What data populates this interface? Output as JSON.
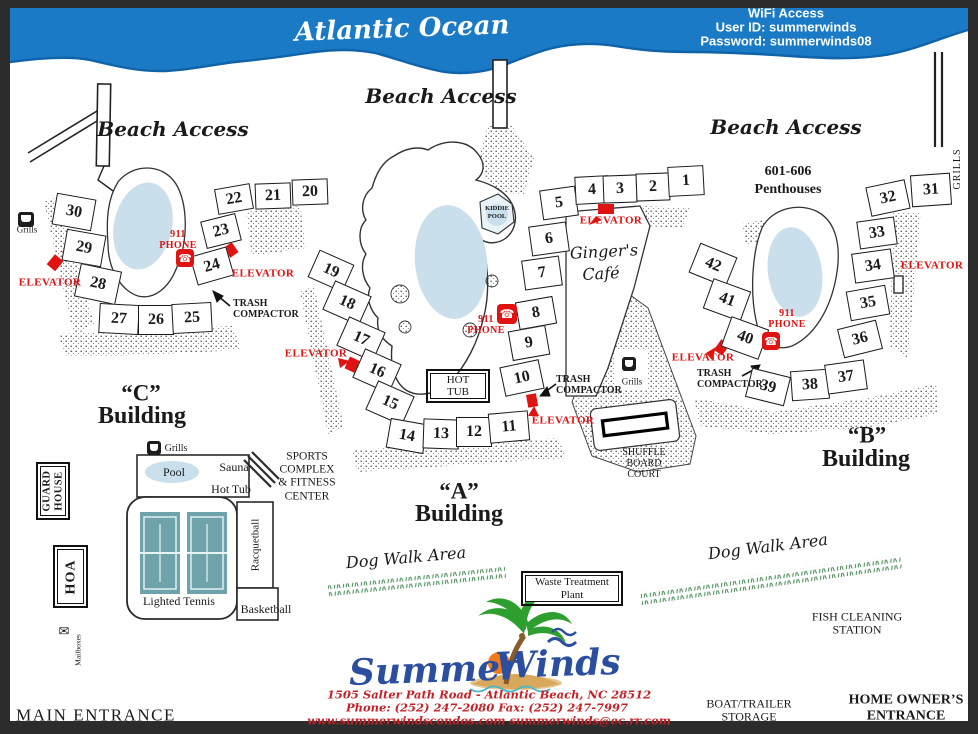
{
  "ocean": {
    "label": "Atlantic Ocean"
  },
  "wifi": {
    "title": "WiFi Access",
    "user": "User ID: summerwinds",
    "password": "Password: summerwinds08"
  },
  "beach_access": {
    "left": "Beach Access",
    "center": "Beach Access",
    "right": "Beach Access"
  },
  "penthouses": {
    "range": "601-606",
    "label": "Penthouses"
  },
  "buildings": {
    "c": {
      "quote": "“C”",
      "label": "Building"
    },
    "a": {
      "quote": "“A”",
      "label": "Building"
    },
    "b": {
      "quote": "“B”",
      "label": "Building"
    }
  },
  "units": {
    "c": [
      "30",
      "29",
      "28",
      "27",
      "26",
      "25",
      "24",
      "23",
      "22",
      "21",
      "20"
    ],
    "a": [
      "19",
      "18",
      "17",
      "16",
      "15",
      "14",
      "13",
      "12",
      "11",
      "10",
      "9",
      "8",
      "7",
      "6",
      "5",
      "4",
      "3",
      "2",
      "1"
    ],
    "b": [
      "42",
      "41",
      "40",
      "39",
      "38",
      "37",
      "36",
      "35",
      "34",
      "33",
      "32",
      "31"
    ]
  },
  "labels": {
    "elevator": "ELEVATOR",
    "trash_line1": "TRASH",
    "trash_line2": "COMPACTOR",
    "phone_line1": "911",
    "phone_line2": "PHONE",
    "grills": "Grills",
    "grills_vertical": "GRILLS",
    "kiddie_line1": "KIDDIE",
    "kiddie_line2": "POOL",
    "gingers_line1": "Ginger's",
    "gingers_line2": "Café",
    "hot_tub_line1": "HOT",
    "hot_tub_line2": "TUB",
    "dog_walk": "Dog Walk Area",
    "shuffle_line1": "SHUFFLE",
    "shuffle_line2": "BOARD",
    "shuffle_line3": "COURT",
    "waste_line1": "Waste Treatment",
    "waste_line2": "Plant",
    "fish_line1": "FISH CLEANING",
    "fish_line2": "STATION",
    "boat_line1": "BOAT/TRAILER",
    "boat_line2": "STORAGE",
    "homeowner_line1": "HOME OWNER’S",
    "homeowner_line2": "ENTRANCE",
    "main_entrance": "MAIN ENTRANCE"
  },
  "sports": {
    "line1": "SPORTS",
    "line2": "COMPLEX",
    "line3": "& FITNESS",
    "line4": "CENTER",
    "pool": "Pool",
    "sauna": "Sauna",
    "hot_tub": "Hot Tub",
    "racquetball": "Racquetball",
    "basketball": "Basketball",
    "tennis": "Lighted Tennis",
    "guard_line1": "GUARD",
    "guard_line2": "HOUSE",
    "hoa": "HOA",
    "mailboxes": "Mailboxes"
  },
  "logo": {
    "name_part1": "Summer",
    "name_part2": "Winds",
    "address": "1505 Salter Path Road  -  Atlantic Beach, NC 28512",
    "phone_fax": "Phone: (252) 247-2080   Fax: (252) 247-7997",
    "web_email": "www.summerwindscondos.com      summerwinds@ec.rr.com"
  },
  "icons": {
    "phone_glyph": "☎",
    "mail_glyph": "✉"
  },
  "colors": {
    "ocean": "#1a7ac6",
    "red": "#e01313",
    "pool": "#c9dfec",
    "logo_blue": "#2b4f9e",
    "grass": "#2f7d3f",
    "court": "#6fa3ab",
    "address_red": "#c42127"
  }
}
